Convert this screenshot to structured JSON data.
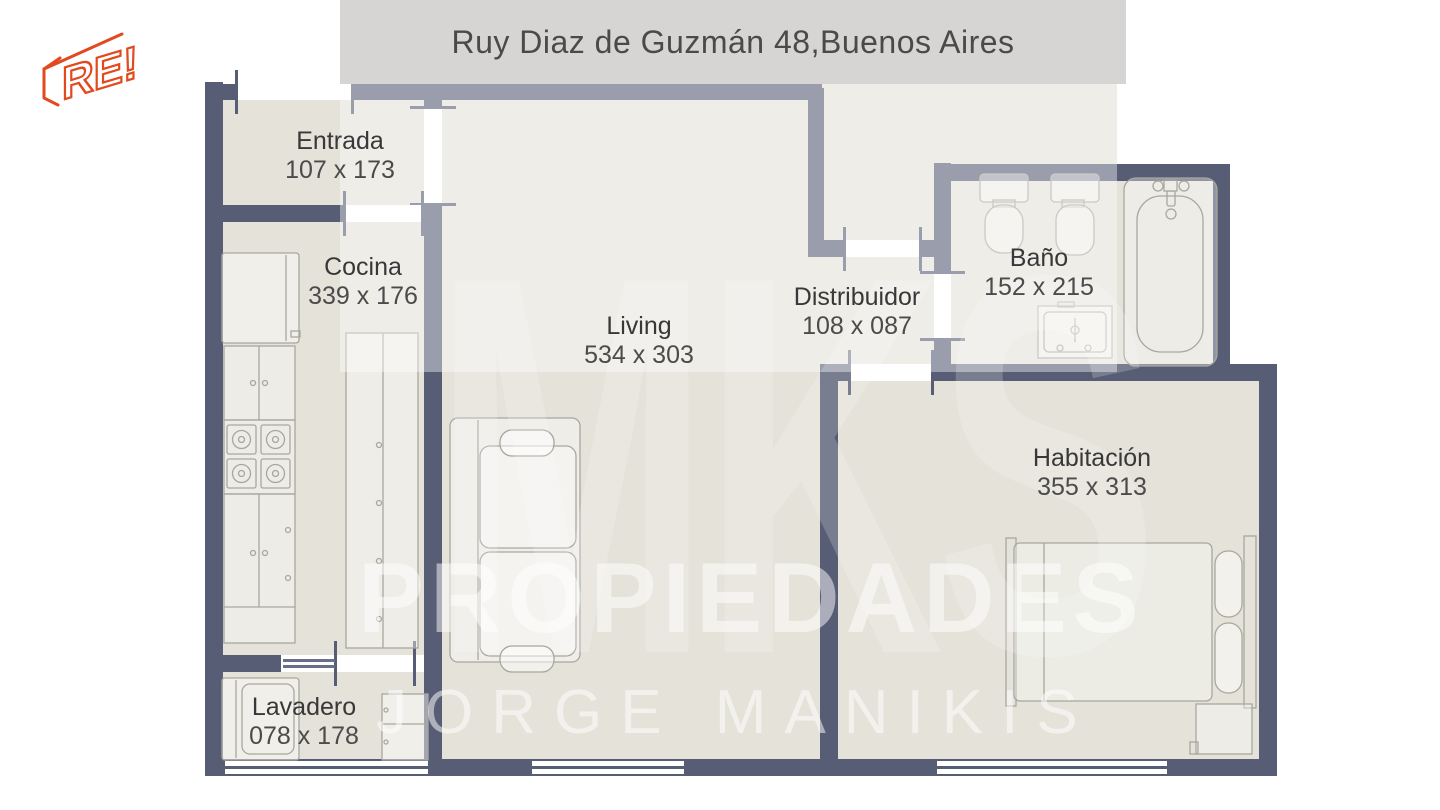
{
  "logo": {
    "text": "RE!",
    "color": "#e2491f"
  },
  "banner": {
    "title": "Ruy Diaz de Guzmán 48,Buenos Aires"
  },
  "watermark": {
    "line1": "MKS",
    "line2": "PROPIEDADES",
    "line3": "JORGE MANIKIS"
  },
  "rooms": [
    {
      "id": "entrada",
      "name": "Entrada",
      "dims": "107 x 173"
    },
    {
      "id": "cocina",
      "name": "Cocina",
      "dims": "339 x 176"
    },
    {
      "id": "living",
      "name": "Living",
      "dims": "534 x 303"
    },
    {
      "id": "distribuidor",
      "name": "Distribuidor",
      "dims": "108 x 087"
    },
    {
      "id": "bano",
      "name": "Baño",
      "dims": "152 x 215"
    },
    {
      "id": "habitacion",
      "name": "Habitación",
      "dims": "355 x 313"
    },
    {
      "id": "lavadero",
      "name": "Lavadero",
      "dims": "078 x 178"
    }
  ],
  "colors": {
    "wall": "#575d74",
    "floor": "#e4e2d9",
    "banner": "#d6d5d3",
    "logo": "#e2491f",
    "label": "#383838",
    "furniture_outline": "#a8a79f"
  }
}
